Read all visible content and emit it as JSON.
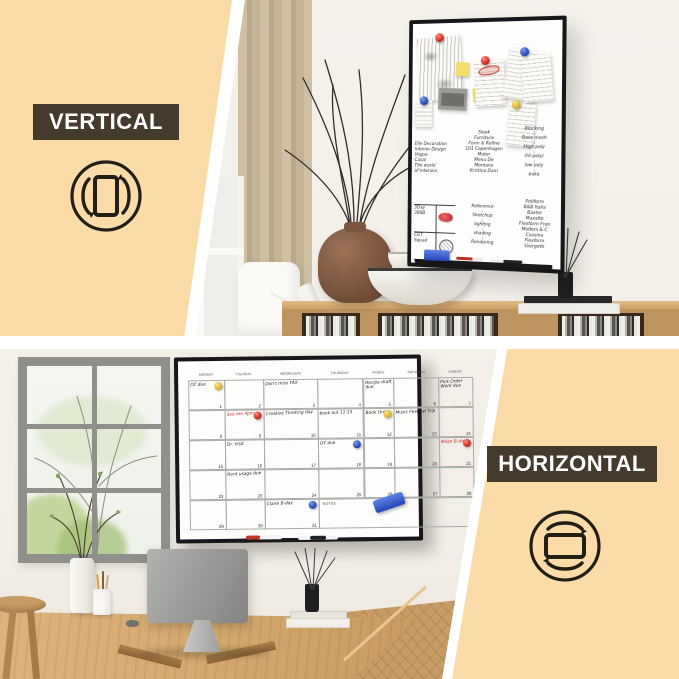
{
  "labels": {
    "vertical": "VERTICAL",
    "horizontal": "HORIZONTAL"
  },
  "colors": {
    "background": "#FBDCA8",
    "label_bg": "#453B2D",
    "label_fg": "#FFFFFF",
    "board_frame": "#17171A",
    "board_face": "#FDFDFC",
    "magnet_red": "#C22014",
    "magnet_blue": "#1C3EAC",
    "magnet_yellow": "#D2A81E",
    "eraser_blue": "#2F5FD8"
  },
  "icons": {
    "vertical_rotate": "portrait-rotate-icon",
    "horizontal_rotate": "landscape-rotate-icon"
  },
  "vertical_board": {
    "left_notes": [
      "Elle Decoration",
      "Interior Design",
      "Vogue",
      "Casal",
      "The world",
      "of interiors"
    ],
    "mid_notes": [
      "Sleek",
      "Furniture",
      "Form & Refine",
      "101 Copenhagen",
      "Mater",
      "Menu De",
      "Montana",
      "Kristina Dam"
    ],
    "right_notes": [
      "Blocking",
      "Base mesh",
      "High poly",
      "(Hi-poly)",
      "low poly",
      "bake"
    ],
    "flow_notes": [
      "Reference",
      "Sketchup",
      "lighting",
      "shading",
      "Rendering"
    ],
    "brand_notes": [
      "Poliform",
      "B&B Italia",
      "Baxter",
      "Maxalto",
      "Flexform Freo",
      "Molteni & C",
      "Cassina",
      "Flexform",
      "Giorgetti"
    ],
    "cell_top_left": "3Day 300B",
    "cell_bottom_left": "CGT Squad"
  },
  "calendar": {
    "day_headers": [
      "MONDAY",
      "TUESDAY",
      "WEDNESDAY",
      "THURSDAY",
      "FRIDAY",
      "SATURDAY",
      "SUNDAY"
    ],
    "notes_label": "NOTES",
    "cells": [
      {
        "day": 1,
        "text": "OT due",
        "magnet": "yellow",
        "color": ""
      },
      {
        "day": 2,
        "text": "",
        "magnet": "",
        "color": ""
      },
      {
        "day": 3,
        "text": "Don't miss TAX",
        "magnet": "",
        "color": ""
      },
      {
        "day": 4,
        "text": "",
        "magnet": "",
        "color": ""
      },
      {
        "day": 5,
        "text": "Recipe draft due",
        "magnet": "",
        "color": ""
      },
      {
        "day": 6,
        "text": "",
        "magnet": "",
        "color": ""
      },
      {
        "day": 7,
        "text": "Pick Order Work due",
        "magnet": "",
        "color": ""
      },
      {
        "day": 8,
        "text": "",
        "magnet": "",
        "color": ""
      },
      {
        "day": 9,
        "text": "See me 4pm",
        "magnet": "red",
        "color": "red"
      },
      {
        "day": 10,
        "text": "Creative Thinking day",
        "magnet": "",
        "color": ""
      },
      {
        "day": 11,
        "text": "book out 11-15",
        "magnet": "",
        "color": ""
      },
      {
        "day": 12,
        "text": "Book Order",
        "magnet": "yellow",
        "color": ""
      },
      {
        "day": 13,
        "text": "Music Festival Trip",
        "magnet": "",
        "color": ""
      },
      {
        "day": 14,
        "text": "",
        "magnet": "",
        "color": ""
      },
      {
        "day": 15,
        "text": "",
        "magnet": "",
        "color": ""
      },
      {
        "day": 16,
        "text": "Dr. Visit",
        "magnet": "",
        "color": ""
      },
      {
        "day": 17,
        "text": "",
        "magnet": "",
        "color": ""
      },
      {
        "day": 18,
        "text": "OT due",
        "magnet": "blue",
        "color": ""
      },
      {
        "day": 19,
        "text": "",
        "magnet": "",
        "color": ""
      },
      {
        "day": 20,
        "text": "",
        "magnet": "",
        "color": ""
      },
      {
        "day": 21,
        "text": "Milan B-day",
        "magnet": "red",
        "color": "red"
      },
      {
        "day": 22,
        "text": "",
        "magnet": "",
        "color": ""
      },
      {
        "day": 23,
        "text": "Rent usage due",
        "magnet": "",
        "color": ""
      },
      {
        "day": 24,
        "text": "",
        "magnet": "",
        "color": ""
      },
      {
        "day": 25,
        "text": "",
        "magnet": "",
        "color": ""
      },
      {
        "day": 26,
        "text": "",
        "magnet": "",
        "color": ""
      },
      {
        "day": 27,
        "text": "",
        "magnet": "",
        "color": ""
      },
      {
        "day": 28,
        "text": "",
        "magnet": "",
        "color": ""
      },
      {
        "day": 29,
        "text": "",
        "magnet": "",
        "color": ""
      },
      {
        "day": 30,
        "text": "",
        "magnet": "",
        "color": ""
      },
      {
        "day": 31,
        "text": "Claire B-day",
        "magnet": "blue",
        "color": ""
      }
    ]
  }
}
